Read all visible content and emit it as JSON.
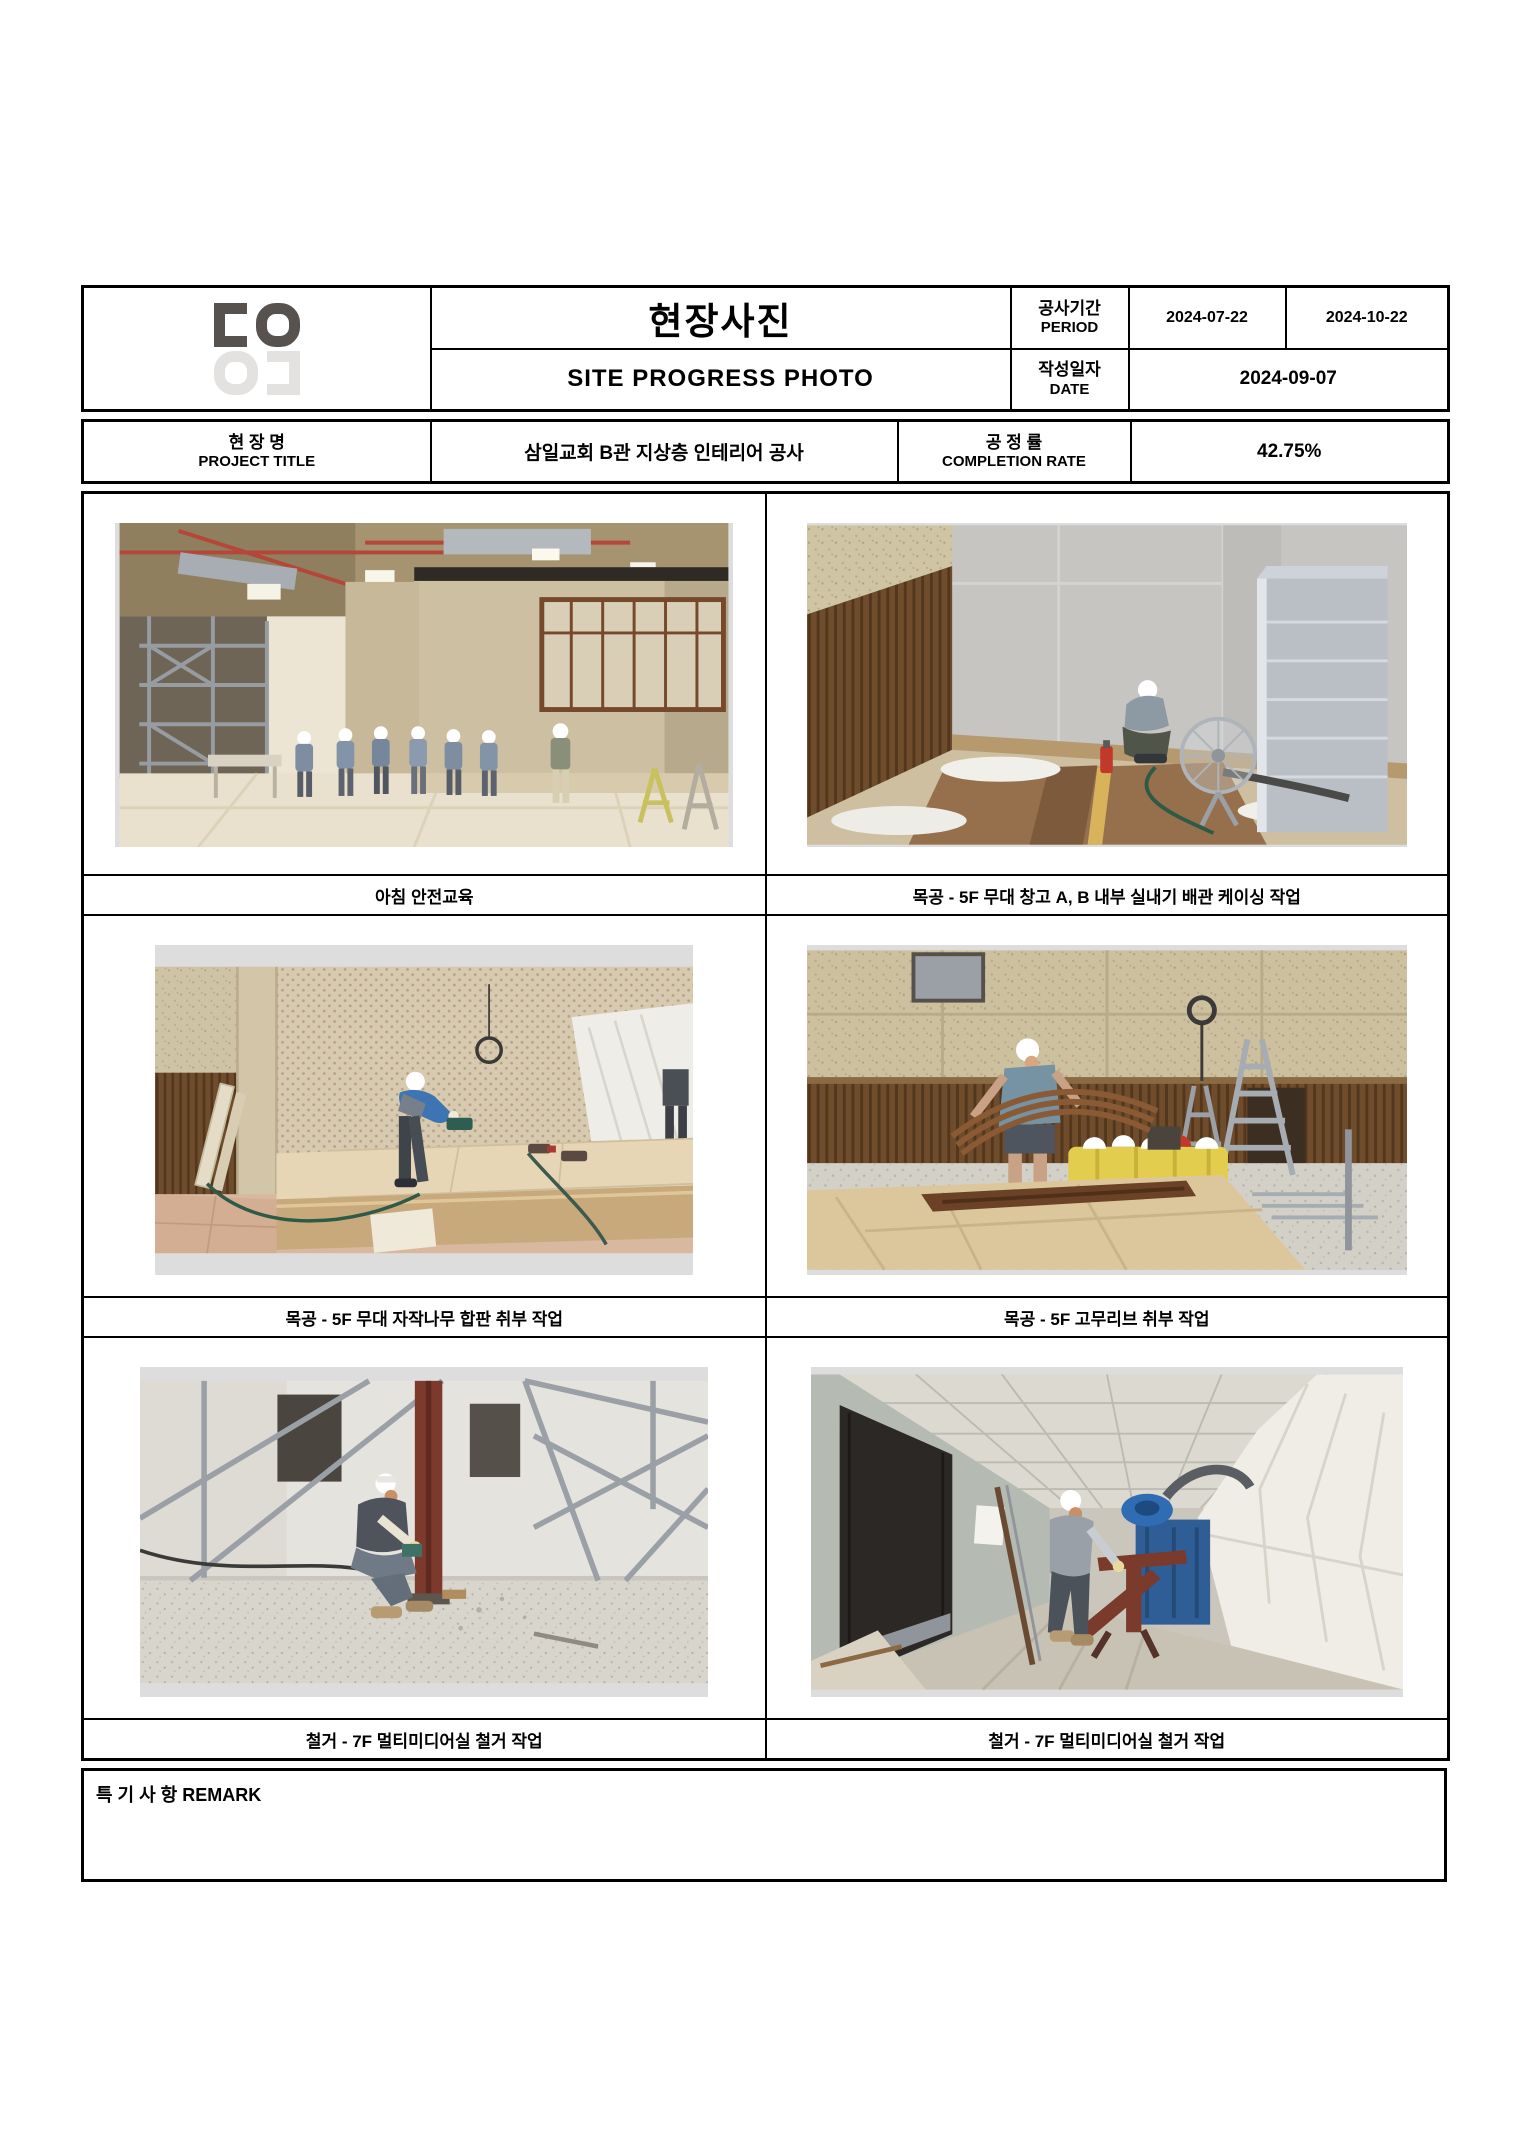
{
  "header": {
    "logo": {
      "glyphs_top": "ㄷO",
      "glyphs_bottom_mirrored": "Oㄷ",
      "color_dark": "#57524e",
      "color_light": "#e4e2e0"
    },
    "title_kr": "현장사진",
    "title_en": "SITE PROGRESS PHOTO",
    "period": {
      "label_kr": "공사기간",
      "label_en": "PERIOD",
      "start": "2024-07-22",
      "end": "2024-10-22"
    },
    "date": {
      "label_kr": "작성일자",
      "label_en": "DATE",
      "value": "2024-09-07"
    }
  },
  "project": {
    "label_kr": "현 장 명",
    "label_en": "PROJECT TITLE",
    "title": "삼일교회 B관 지상층 인테리어 공사",
    "rate_label_kr": "공 정 률",
    "rate_label_en": "COMPLETION RATE",
    "rate_value": "42.75%"
  },
  "photos": [
    {
      "caption": "아침 안전교육",
      "scene": "group-safety-briefing-in-hall"
    },
    {
      "caption": "목공 - 5F 무대 창고 A, B 내부 실내기 배관 케이싱 작업",
      "scene": "worker-crouching-storage-room"
    },
    {
      "caption": "목공 - 5F 무대 자작나무 합판 취부 작업",
      "scene": "worker-cutting-plywood-stage-edge"
    },
    {
      "caption": "목공 - 5F 고무리브 취부 작업",
      "scene": "worker-carrying-curved-ribs"
    },
    {
      "caption": "철거 - 7F 멀티미디어실 철거 작업",
      "scene": "worker-at-red-steel-column"
    },
    {
      "caption": "철거 - 7F 멀티미디어실 철거 작업",
      "scene": "worker-in-corridor-with-sheeting"
    }
  ],
  "remark": {
    "label": "특 기 사 항 REMARK",
    "content": ""
  },
  "colors": {
    "table_border": "#000000",
    "page_background": "#ffffff"
  }
}
